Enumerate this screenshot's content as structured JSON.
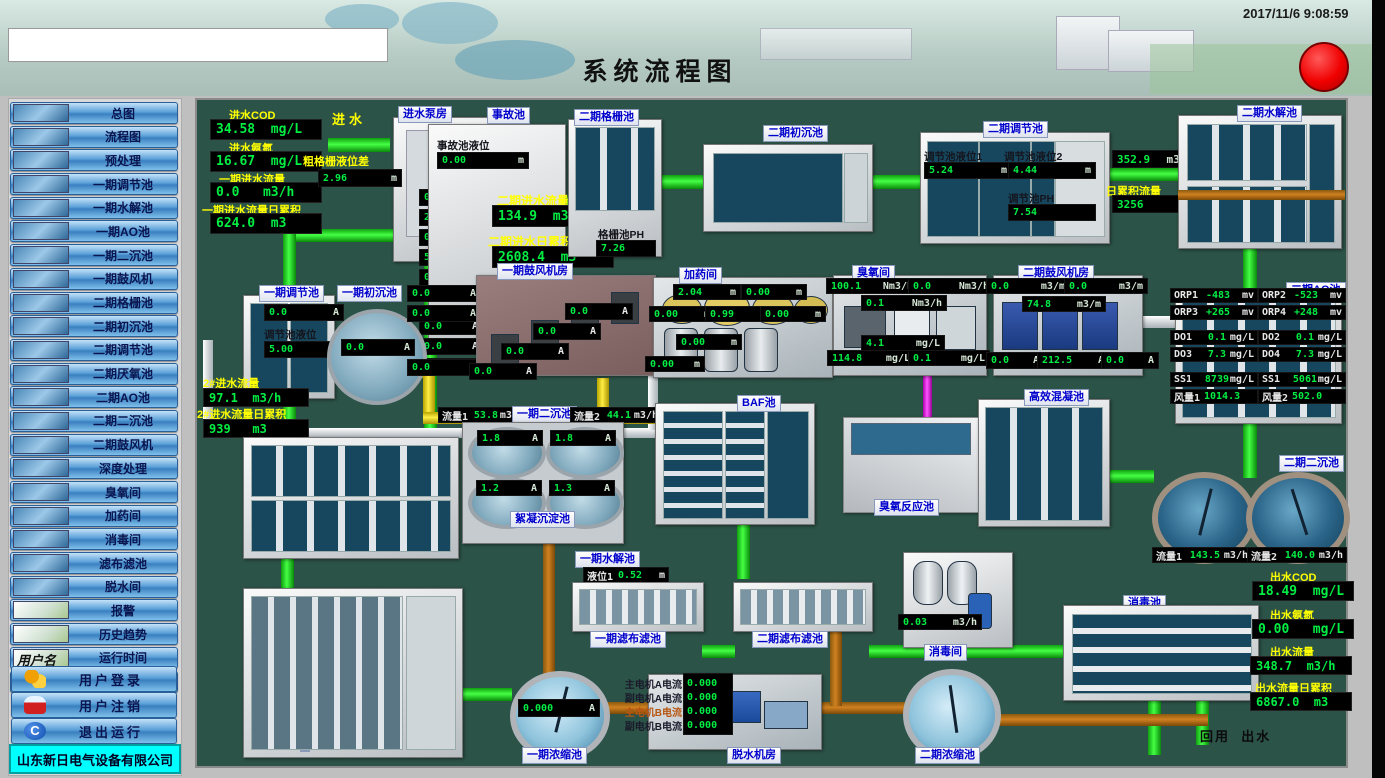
{
  "header": {
    "title": "系统流程图",
    "datetime": "2017/11/6 9:08:59"
  },
  "sidebar": {
    "items": [
      "总图",
      "流程图",
      "预处理",
      "一期调节池",
      "一期水解池",
      "一期AO池",
      "一期二沉池",
      "一期鼓风机",
      "二期格栅池",
      "二期初沉池",
      "二期调节池",
      "二期厌氧池",
      "二期AO池",
      "二期二沉池",
      "二期鼓风机",
      "深度处理",
      "臭氧间",
      "加药间",
      "消毒间",
      "滤布滤池",
      "脱水间",
      "报警",
      "历史趋势",
      "运行时间",
      "数据报表"
    ],
    "username_label": "用户名",
    "login": "用户登录",
    "logout": "用户注销",
    "exit": "退出运行",
    "company": "山东新日电气设备有限公司"
  },
  "colors": {
    "panel_bg": "#2c5348",
    "value_green": "#00ee44",
    "label_yellow": "#ffff00",
    "tag_blue": "#0000cc",
    "company_bg": "#00ffff",
    "alarm_red": "#f00000"
  },
  "diagram": {
    "inlet": {
      "in_label": "进水",
      "cod_label": "进水COD",
      "cod": "34.58  mg/L",
      "nh3_label": "进水氨氮",
      "nh3": "16.67  mg/L",
      "flow_label": "一期进水流量",
      "flow": "0.0   m3/h",
      "total_label": "一期进水流量日累积",
      "total": "624.0  m3"
    },
    "pumphouse": {
      "title": "进水泵房",
      "grid_label": "粗格栅液位差",
      "grid_level": [
        "2.96",
        "m"
      ],
      "currents": [
        [
          "0.0",
          "A"
        ],
        [
          "25.7",
          "A"
        ],
        [
          "0.0",
          "A"
        ],
        [
          "5.9",
          "A"
        ],
        [
          "0.0",
          "A"
        ]
      ]
    },
    "accident": {
      "title": "事故池",
      "level_label": "事故池液位",
      "level": [
        "0.00",
        "m"
      ],
      "currents": [
        [
          "0.0",
          "A"
        ],
        [
          "0.0",
          "A"
        ],
        [
          "0.0",
          "A"
        ]
      ]
    },
    "p2in": {
      "flow_label": "二期进水流量",
      "flow": "134.9  m3/h",
      "total_label": "二期进水日累积",
      "total": "2608.4  m3"
    },
    "grille2": {
      "title": "二期格栅池",
      "ph_label": "格栅池PH",
      "ph": [
        "7.26",
        ""
      ]
    },
    "primary2": {
      "title": "二期初沉池"
    },
    "regulate2": {
      "title": "二期调节池",
      "lv1_label": "调节池液位1",
      "lv1": [
        "5.24",
        "m"
      ],
      "lv2_label": "调节池液位2",
      "lv2": [
        "4.44",
        "m"
      ],
      "ph_label": "调节池PH",
      "ph": [
        "7.54",
        ""
      ]
    },
    "hydrolysis2": {
      "title": "二期水解池",
      "flow": [
        "352.9",
        "m3/h"
      ],
      "total_label": "日累积流量",
      "total": [
        "3256",
        "m3"
      ]
    },
    "regulate1": {
      "title": "一期调节池",
      "current": [
        "0.0",
        "A"
      ],
      "level_label": "调节池液位",
      "level": [
        "5.00",
        "m"
      ]
    },
    "primary1": {
      "title": "一期初沉池",
      "currents": [
        [
          "0.0",
          "A"
        ],
        [
          "0.0",
          "A"
        ],
        [
          "0.0",
          "A"
        ],
        [
          "0.0",
          "A"
        ]
      ]
    },
    "blower1": {
      "title": "一期鼓风机房",
      "currents": [
        [
          "0.0",
          "A"
        ],
        [
          "0.0",
          "A"
        ],
        [
          "0.0",
          "A"
        ],
        [
          "0.0",
          "A"
        ]
      ]
    },
    "dosing": {
      "title": "加药间",
      "levels": [
        [
          "2.04",
          "m"
        ],
        [
          "0.00",
          "m"
        ],
        [
          "0.00",
          "m"
        ],
        [
          "0.99",
          "m"
        ],
        [
          "0.00",
          "m"
        ],
        [
          "0.00",
          "m"
        ],
        [
          "0.00",
          "m"
        ]
      ]
    },
    "ozone": {
      "title": "臭氧间",
      "values": [
        [
          "100.1",
          "Nm3/h"
        ],
        [
          "0.0",
          "Nm3/h"
        ],
        [
          "0.1",
          "Nm3/h"
        ],
        [
          "4.1",
          "mg/L"
        ],
        [
          "114.8",
          "mg/L"
        ],
        [
          "0.1",
          "mg/L"
        ]
      ]
    },
    "blower2": {
      "title": "二期鼓风机房",
      "flows": [
        [
          "0.0",
          "m3/m"
        ],
        [
          "0.0",
          "m3/m"
        ],
        [
          "74.8",
          "m3/m"
        ]
      ],
      "currents": [
        [
          "0.0",
          "A"
        ],
        [
          "212.5",
          "A"
        ],
        [
          "0.0",
          "A"
        ]
      ]
    },
    "ao2": {
      "title": "二期AO池",
      "left": [
        [
          "ORP1",
          "-483",
          "mv"
        ],
        [
          "ORP3",
          "+265",
          "mv"
        ],
        [
          "DO1",
          "0.1",
          "mg/L"
        ],
        [
          "DO3",
          "7.3",
          "mg/L"
        ],
        [
          "SS1",
          "8739",
          "mg/L"
        ],
        [
          "风量1",
          "1014.3",
          ""
        ]
      ],
      "right": [
        [
          "ORP2",
          "-523",
          "mv"
        ],
        [
          "ORP4",
          "+248",
          "mv"
        ],
        [
          "DO2",
          "0.1",
          "mg/L"
        ],
        [
          "DO4",
          "7.3",
          "mg/L"
        ],
        [
          "SS1",
          "5061",
          "mg/L"
        ],
        [
          "风量2",
          "502.0",
          ""
        ]
      ]
    },
    "p2flow": {
      "flow_label": "2#进水流量",
      "flow": "97.1  m3/h",
      "total_label": "2#进水流量日累积",
      "total": "939   m3"
    },
    "secondary1": {
      "title": "一期二沉池",
      "f1": [
        "流量1",
        "53.8",
        "m3/h"
      ],
      "f2": [
        "流量2",
        "44.1",
        "m3/h"
      ],
      "currents": [
        [
          "1.8",
          "A"
        ],
        [
          "1.8",
          "A"
        ],
        [
          "1.2",
          "A"
        ],
        [
          "1.3",
          "A"
        ]
      ],
      "floc_label": "絮凝沉淀池"
    },
    "baf": {
      "title": "BAF池"
    },
    "ozonereact": {
      "title": "臭氧反应池"
    },
    "coag": {
      "title": "高效混凝池"
    },
    "secondary2": {
      "title": "二期二沉池",
      "f1": [
        "流量1",
        "143.5",
        "m3/h"
      ],
      "f2": [
        "流量2",
        "140.0",
        "m3/h"
      ]
    },
    "hydrolysis1": {
      "title": "一期水解池"
    },
    "cloth1": {
      "title": "一期滤布滤池",
      "level": [
        "液位1",
        "0.52",
        "m"
      ]
    },
    "cloth2": {
      "title": "二期滤布滤池"
    },
    "disinfect_room": {
      "title": "消毒间",
      "flow": [
        "0.03",
        "m3/h"
      ]
    },
    "disinfect_pool": {
      "title": "消毒池"
    },
    "thicken1": {
      "title": "一期浓缩池",
      "current": [
        "0.000",
        "A"
      ]
    },
    "dewater": {
      "title": "脱水机房",
      "labels": [
        "主电机A电流",
        "副电机A电流",
        "主电机B电流",
        "副电机B电流"
      ],
      "values": [
        "0.000",
        "0.000",
        "0.000",
        "0.000"
      ]
    },
    "thicken2": {
      "title": "二期浓缩池"
    },
    "outlet": {
      "cod_label": "出水COD",
      "cod": "18.49  mg/L",
      "nh3_label": "出水氨氮",
      "nh3": "0.00   mg/L",
      "flow_label": "出水流量",
      "flow": "348.7  m3/h",
      "total_label": "出水流量日累积",
      "total": "6867.0  m3",
      "reuse": "回用",
      "out": "出水"
    }
  }
}
